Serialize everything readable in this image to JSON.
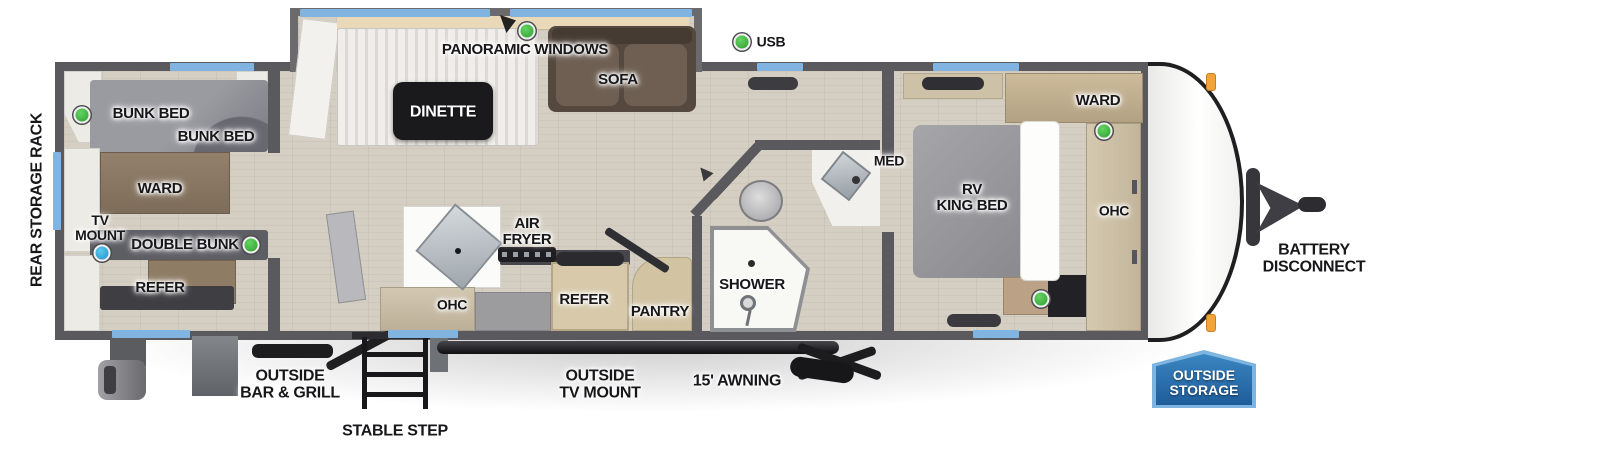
{
  "colors": {
    "marker_green": "#3fbf3f",
    "marker_blue": "#2aa9e0",
    "window_blue": "#82b4e2",
    "badge_blue": "#2a6cab",
    "wall_gray": "#5a5a5e",
    "clearance_light_orange": "#f2a43c"
  },
  "bunk_room": {
    "bunk_bed_upper": "BUNK BED",
    "bunk_bed_lower": "BUNK BED",
    "ward": "WARD",
    "tv_mount": "TV\nMOUNT",
    "double_bunk": "DOUBLE BUNK",
    "refer": "REFER"
  },
  "slide_out": {
    "panoramic_windows": "PANORAMIC WINDOWS",
    "dinette": "DINETTE",
    "sofa": "SOFA"
  },
  "living": {
    "usb": "USB"
  },
  "kitchen": {
    "air_fryer": "AIR\nFRYER",
    "ohc": "OHC",
    "refer": "REFER",
    "pantry": "PANTRY"
  },
  "bathroom": {
    "shower": "SHOWER",
    "med": "MED"
  },
  "bedroom": {
    "ward": "WARD",
    "rv_king_bed": "RV\nKING BED",
    "ohc": "OHC"
  },
  "exterior": {
    "rear_storage_rack": "REAR STORAGE RACK",
    "battery_disconnect": "BATTERY\nDISCONNECT",
    "outside_storage": "OUTSIDE\nSTORAGE",
    "outside_bar_grill": "OUTSIDE\nBAR & GRILL",
    "stable_step": "STABLE STEP",
    "outside_tv_mount": "OUTSIDE\nTV MOUNT",
    "awning_15ft": "15' AWNING"
  }
}
